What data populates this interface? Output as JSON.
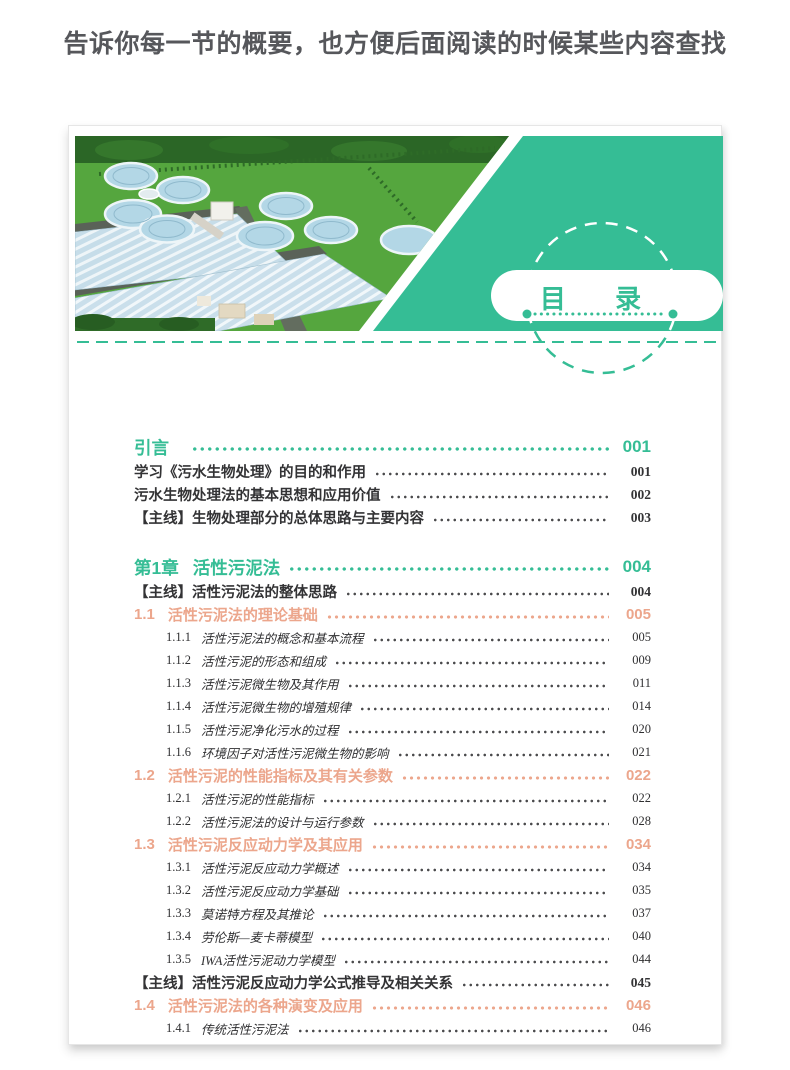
{
  "headline": "告诉你每一节的概要，也方便后面阅读的时候某些内容查找",
  "page": {
    "header": {
      "title": "目 录",
      "photo": "aerial-view-wastewater-treatment-plant"
    },
    "toc": {
      "entries": [
        {
          "level": "chapter",
          "num": "引言",
          "title": "",
          "page": "001"
        },
        {
          "level": "main",
          "num": "",
          "title": "学习《污水生物处理》的目的和作用",
          "page": "001"
        },
        {
          "level": "main",
          "num": "",
          "title": "污水生物处理法的基本思想和应用价值",
          "page": "002"
        },
        {
          "level": "main",
          "num": "",
          "title": "【主线】生物处理部分的总体思路与主要内容",
          "page": "003"
        },
        {
          "level": "chapter",
          "num": "第1章",
          "title": "活性污泥法",
          "page": "004",
          "gap": true
        },
        {
          "level": "main",
          "num": "",
          "title": "【主线】活性污泥法的整体思路",
          "page": "004"
        },
        {
          "level": "section",
          "num": "1.1",
          "title": "活性污泥法的理论基础",
          "page": "005"
        },
        {
          "level": "sub",
          "num": "1.1.1",
          "title": "活性污泥法的概念和基本流程",
          "page": "005"
        },
        {
          "level": "sub",
          "num": "1.1.2",
          "title": "活性污泥的形态和组成",
          "page": "009"
        },
        {
          "level": "sub",
          "num": "1.1.3",
          "title": "活性污泥微生物及其作用",
          "page": "011"
        },
        {
          "level": "sub",
          "num": "1.1.4",
          "title": "活性污泥微生物的增殖规律",
          "page": "014"
        },
        {
          "level": "sub",
          "num": "1.1.5",
          "title": "活性污泥净化污水的过程",
          "page": "020"
        },
        {
          "level": "sub",
          "num": "1.1.6",
          "title": "环境因子对活性污泥微生物的影响",
          "page": "021"
        },
        {
          "level": "section",
          "num": "1.2",
          "title": "活性污泥的性能指标及其有关参数",
          "page": "022"
        },
        {
          "level": "sub",
          "num": "1.2.1",
          "title": "活性污泥的性能指标",
          "page": "022"
        },
        {
          "level": "sub",
          "num": "1.2.2",
          "title": "活性污泥法的设计与运行参数",
          "page": "028"
        },
        {
          "level": "section",
          "num": "1.3",
          "title": "活性污泥反应动力学及其应用",
          "page": "034"
        },
        {
          "level": "sub",
          "num": "1.3.1",
          "title": "活性污泥反应动力学概述",
          "page": "034"
        },
        {
          "level": "sub",
          "num": "1.3.2",
          "title": "活性污泥反应动力学基础",
          "page": "035"
        },
        {
          "level": "sub",
          "num": "1.3.3",
          "title": "莫诺特方程及其推论",
          "page": "037"
        },
        {
          "level": "sub",
          "num": "1.3.4",
          "title": "劳伦斯—麦卡蒂模型",
          "page": "040"
        },
        {
          "level": "sub",
          "num": "1.3.5",
          "title": "IWA活性污泥动力学模型",
          "page": "044"
        },
        {
          "level": "main",
          "num": "",
          "title": "【主线】活性污泥反应动力学公式推导及相关关系",
          "page": "045"
        },
        {
          "level": "section",
          "num": "1.4",
          "title": "活性污泥法的各种演变及应用",
          "page": "046"
        },
        {
          "level": "sub",
          "num": "1.4.1",
          "title": "传统活性污泥法",
          "page": "046"
        }
      ]
    }
  },
  "colors": {
    "teal": "#35bd95",
    "salmon": "#eca68c",
    "headline_gray": "#56575b",
    "text_dark": "#2f2f31"
  }
}
